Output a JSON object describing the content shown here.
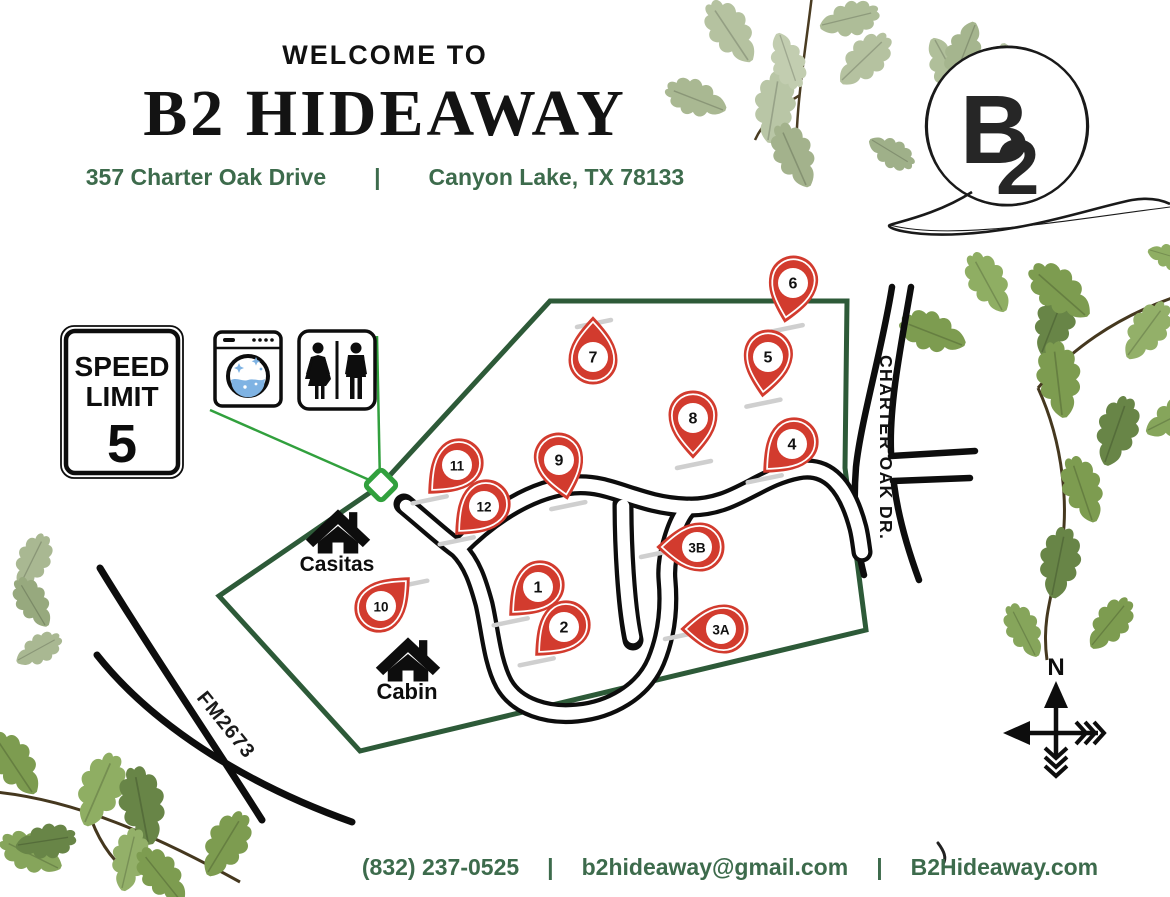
{
  "header": {
    "welcome": "WELCOME TO",
    "title": "B2 HIDEAWAY",
    "address_left": "357 Charter Oak Drive",
    "separator": "|",
    "address_right": "Canyon Lake, TX 78133"
  },
  "logo": {
    "monogram_b": "B",
    "monogram_2": "2"
  },
  "speed_sign": {
    "line1": "SPEED",
    "line2": "LIMIT",
    "line3": "5"
  },
  "map": {
    "labels": {
      "casitas": "Casitas",
      "cabin": "Cabin",
      "road_fm": "FM2673",
      "road_charter": "CHARTER OAK DR.",
      "compass_n": "N"
    },
    "pins": [
      {
        "label": "1",
        "x": 538,
        "y": 587,
        "rot": 45
      },
      {
        "label": "2",
        "x": 564,
        "y": 627,
        "rot": 45
      },
      {
        "label": "3B",
        "x": 697,
        "y": 547,
        "rot": 90
      },
      {
        "label": "3A",
        "x": 721,
        "y": 629,
        "rot": 90
      },
      {
        "label": "4",
        "x": 792,
        "y": 444,
        "rot": 45
      },
      {
        "label": "5",
        "x": 768,
        "y": 357,
        "rot": 8
      },
      {
        "label": "6",
        "x": 793,
        "y": 283,
        "rot": 12
      },
      {
        "label": "7",
        "x": 593,
        "y": 357,
        "rot": 180
      },
      {
        "label": "8",
        "x": 693,
        "y": 418,
        "rot": 0
      },
      {
        "label": "9",
        "x": 559,
        "y": 460,
        "rot": -12
      },
      {
        "label": "10",
        "x": 381,
        "y": 606,
        "rot": 225
      },
      {
        "label": "11",
        "x": 457,
        "y": 465,
        "rot": 45
      },
      {
        "label": "12",
        "x": 484,
        "y": 506,
        "rot": 45
      }
    ]
  },
  "footer": {
    "phone": "(832) 237-0525",
    "separator": "|",
    "email": "b2hideaway@gmail.com",
    "separator2": "|",
    "website": "B2Hideaway.com"
  },
  "colors": {
    "pin_red": "#d23b2e",
    "boundary_green": "#2d5a38",
    "accent_green": "#31a03d",
    "text_green": "#3d6b4c",
    "water_blue": "#7fb3e3",
    "road_black": "#0d0d0d"
  }
}
